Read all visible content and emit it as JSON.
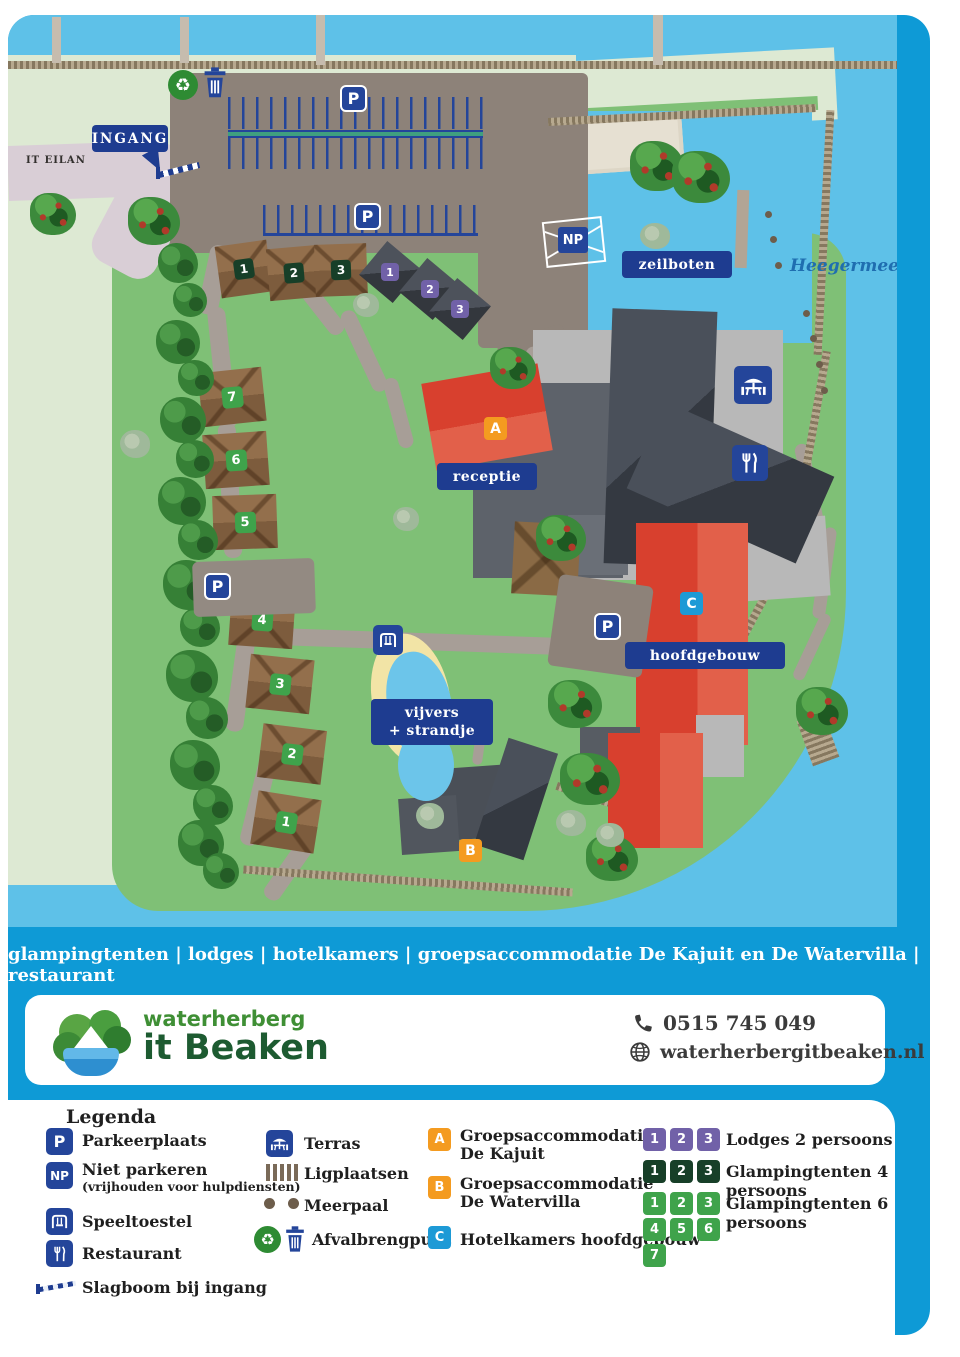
{
  "tagline": "glampingtenten | lodges | hotelkamers | groepsaccommodatie De Kajuit en De Watervilla | restaurant",
  "map": {
    "labels": {
      "ingang": "INGANG",
      "it_eilan": "IT EILAN",
      "zeilboten": "zeilboten",
      "heegermeer": "Heegermeer",
      "receptie": "receptie",
      "hoofdgebouw": "hoofdgebouw",
      "vijvers_line1": "vijvers",
      "vijvers_line2": "+ strandje",
      "parking": "P",
      "no_parking": "NP"
    },
    "markers": {
      "a": "A",
      "b": "B",
      "c": "C",
      "glamping6": [
        "1",
        "2",
        "3",
        "4",
        "5",
        "6",
        "7"
      ],
      "glamping4": [
        "1",
        "2",
        "3"
      ],
      "lodges": [
        "1",
        "2",
        "3"
      ]
    }
  },
  "footer": {
    "logo_line1": "waterherberg",
    "logo_line2": "it Beaken",
    "phone": "0515 745 049",
    "website": "waterherbergitbeaken.nl"
  },
  "legend": {
    "title": "Legenda",
    "parkeerplaats": "Parkeerplaats",
    "niet_parkeren": "Niet parkeren",
    "niet_parkeren_sub": "(vrijhouden voor hulpdiensten)",
    "speeltoestel": "Speeltoestel",
    "restaurant": "Restaurant",
    "slagboom": "Slagboom bij ingang",
    "terras": "Terras",
    "ligplaatsen": "Ligplaatsen",
    "meerpaal": "Meerpaal",
    "afvalbrengpunt": "Afvalbrengpunt",
    "a_line1": "Groepsaccommodatie",
    "a_line2": "De Kajuit",
    "b_line1": "Groepsaccommodatie",
    "b_line2": "De Watervilla",
    "c_label": "Hotelkamers hoofdgebouw",
    "lodges_label": "Lodges 2 persoons",
    "glamping4_label": "Glampingtenten 4 persoons",
    "glamping6_label": "Glampingtenten 6 persoons",
    "lodges_numbers": [
      "1",
      "2",
      "3"
    ],
    "glamping4_numbers": [
      "1",
      "2",
      "3"
    ],
    "glamping6_numbers": [
      "1",
      "2",
      "3",
      "4",
      "5",
      "6",
      "7"
    ]
  },
  "colors": {
    "card_blue": "#0e9ad6",
    "water_blue": "#5ec1e8",
    "land_green": "#7fc076",
    "pale_green": "#dde9d3",
    "label_navy": "#1e3c90",
    "sign_navy": "#24459a",
    "marker_orange": "#f49b20",
    "marker_c_blue": "#1d9ad6",
    "lodge_purple": "#7161a8",
    "glamping4_green": "#173f28",
    "glamping6_green": "#3fa34b",
    "building_red": "#d8402e",
    "building_dark": "#3f444b",
    "tent_brown": "#8a6747"
  }
}
